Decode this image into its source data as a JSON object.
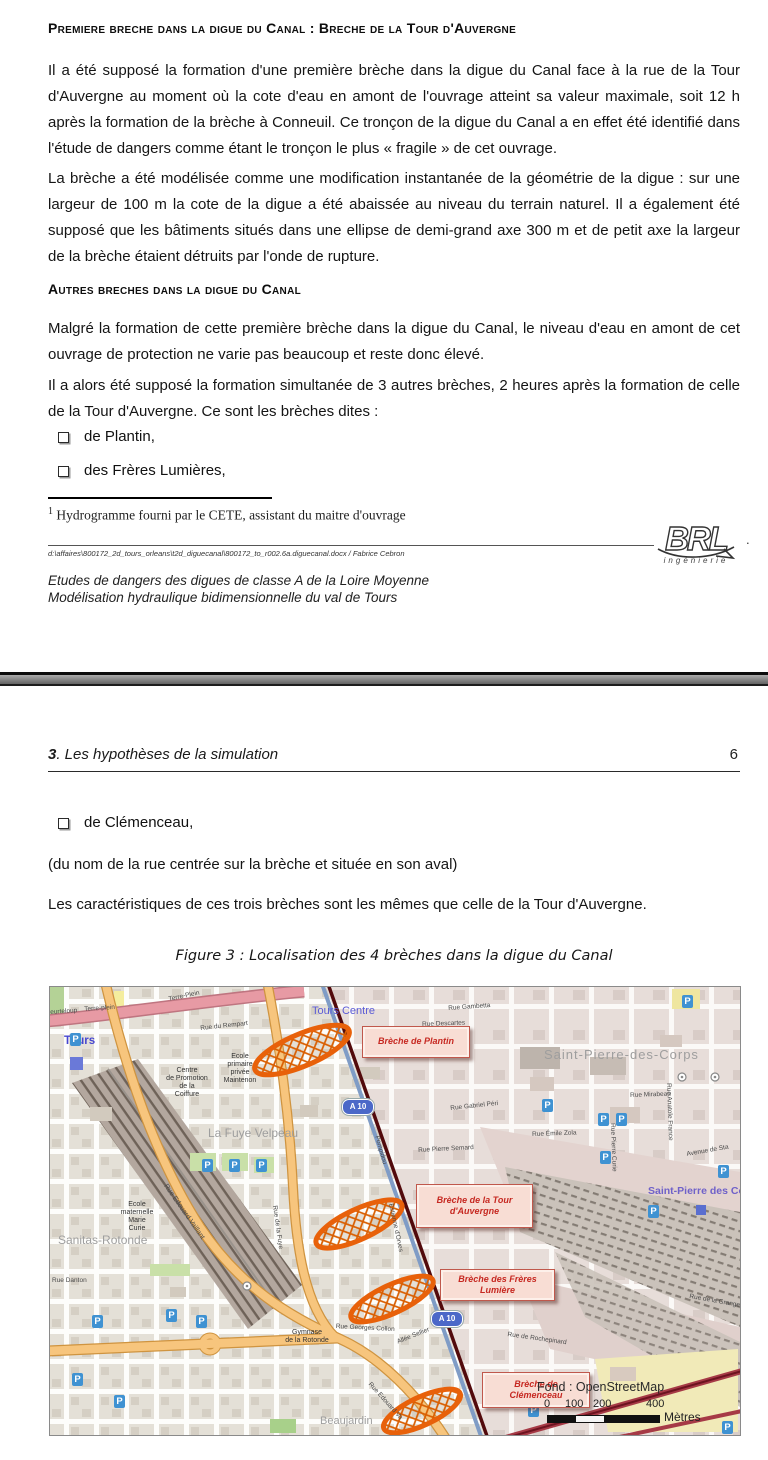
{
  "page1": {
    "heading1": "Premiere breche dans la digue du Canal : Breche de la Tour d'Auvergne",
    "para1": "Il a été supposé la formation d'une première brèche dans la digue du Canal face à la rue de la Tour d'Auvergne au moment où la cote d'eau en amont de l'ouvrage atteint sa valeur maximale, soit 12 h après la formation de la brèche à Conneuil. Ce tronçon de la digue du Canal a en effet été identifié dans l'étude de dangers comme étant le tronçon le plus « fragile » de cet ouvrage.",
    "para2": "La brèche a été modélisée comme une modification instantanée de la géométrie de la digue : sur une largeur de 100 m la cote de la digue a été abaissée au niveau du terrain naturel. Il a également été supposé que les bâtiments situés dans une ellipse de demi-grand axe 300 m et de petit axe la largeur de la brèche étaient détruits par l'onde de rupture.",
    "heading2": "Autres breches dans la digue du Canal",
    "para3": "Malgré la formation de cette première brèche dans la digue du Canal, le niveau d'eau en amont de cet ouvrage de protection ne varie pas beaucoup et reste donc élevé.",
    "para4": "Il a alors été supposé la formation simultanée de 3 autres brèches, 2 heures après la formation de celle de la Tour d'Auvergne. Ce sont les brèches dites :",
    "bullets": [
      "de Plantin,",
      "des Frères Lumières,"
    ],
    "footnote": {
      "marker": "1",
      "text": "Hydrogramme fourni par le CETE, assistant du maitre d'ouvrage"
    },
    "footer": {
      "path": "d:\\affaires\\800172_2d_tours_orleans\\t2d_diguecanal\\800172_to_r002.6a.diguecanal.docx / Fabrice Cebron",
      "title_line1": "Etudes de dangers des digues de classe A de la Loire Moyenne",
      "title_line2": "Modélisation hydraulique bidimensionnelle du val de Tours",
      "logo_text": "BRL",
      "logo_sub": "ingénierie",
      "dot": "."
    }
  },
  "page2": {
    "header": {
      "chapter_num": "3",
      "chapter_title": ". Les hypothèses de la simulation",
      "page_number": "6"
    },
    "bullet": "de Clémenceau,",
    "para1": "(du nom de la rue centrée sur la brèche et située en son aval)",
    "para2": "Les caractéristiques de ces trois brèches sont les mêmes que celle de la Tour d'Auvergne.",
    "figure_caption": "Figure 3 : Localisation des 4 brèches dans la digue du Canal"
  },
  "map": {
    "breaches": [
      {
        "line1": "Brèche de Plantin",
        "line2": ""
      },
      {
        "line1": "Brèche de la Tour",
        "line2": "d'Auvergne"
      },
      {
        "line1": "Brèche des Frères",
        "line2": "Lumière"
      },
      {
        "line1": "Brèche de",
        "line2": "Clémenceau"
      }
    ],
    "districts": {
      "tours": "Tours",
      "tours_centre": "Tours Centre",
      "spdc": "Saint-Pierre-des-Corps",
      "spdc2": "Saint-Pierre des Co",
      "fuye_velpeau": "La Fuye Velpeau",
      "sanitas": "Sanitas-Rotonde",
      "beaujardin": "Beaujardin"
    },
    "pois": {
      "maintenon": "Ecole\nprimaire\nprivée\nMaintenon",
      "coiffure": "Centre\nde Promotion\nde la\nCoiffure",
      "marie_curie": "Ecole\nmaternelle\nMarie\nCurie",
      "gymnase": "Gymnase\nde la Rotonde"
    },
    "streets": {
      "heurteloup": "eurteloup",
      "terre_plein": "Terre-plein",
      "terre_plein2": "Terre-Plein",
      "rempart": "Rue du Rempart",
      "gambetta": "Rue Gambetta",
      "descartes": "Rue Descartes",
      "gabriel_peri": "Rue Gabriel Péri",
      "emile_zola": "Rue Émile Zola",
      "mirabeau": "Rue Mirabeau",
      "pierre_semard": "Rue Pierre Semard",
      "avenue_sta": "Avenue de Sta",
      "edouard_vaillant": "Rue Edouard Vaillant",
      "edouard_vaillant2": "Rue Edouard Va",
      "fuye": "Rue de la Fuye",
      "georges_collon": "Rue Georges Collon",
      "rochepinard": "Rue de Rochepinard",
      "allee_sellier": "Allée Sellier",
      "pierre_curie": "Rue Pierre Curie",
      "anatole_france": "Rue Anatole France",
      "grange": "Rue de la Grange",
      "pompidou": "Pompidou",
      "estienne_orves": "Estienne d'Orves",
      "danton": "Rue Danton"
    },
    "motorway_shield": "A 10",
    "parking_glyph": "P",
    "scale": {
      "attribution": "Fond : OpenStreetMap",
      "ticks": [
        "0",
        "100",
        "200",
        "400"
      ],
      "unit": "Mètres"
    },
    "colors": {
      "breach_outline": "#e8610a",
      "breach_label_text": "#c62821",
      "breach_label_bg": "#f8ddd4",
      "canal": "#520a0c",
      "motorway_blue": "#7f9cc6",
      "road_orange": "#f7c57d",
      "road_pink": "#e79aa4",
      "separator_gray": "#808080"
    }
  }
}
